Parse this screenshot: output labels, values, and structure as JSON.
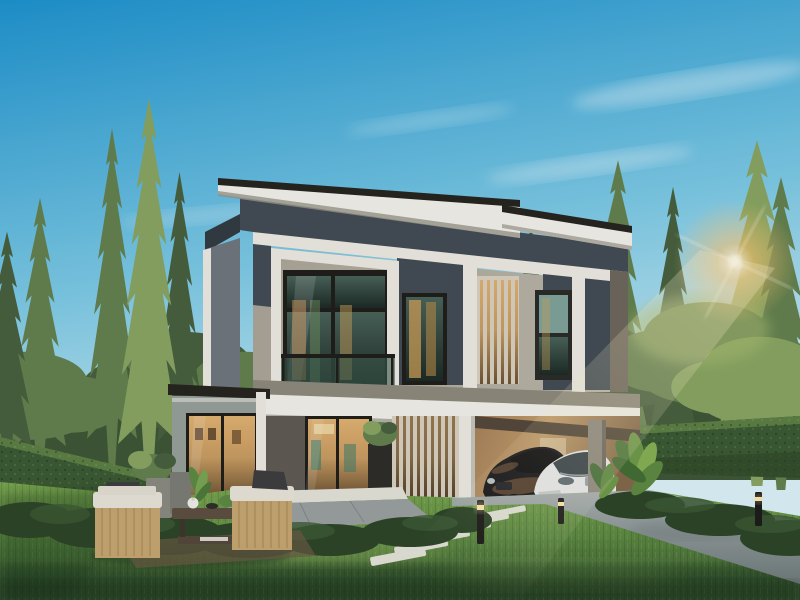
{
  "image": {
    "type": "3d-architectural-rendering",
    "description": "Exterior rendering of a modern two-storey detached house with slanted dark roof, glass balcony, timber louver screens, carport with two cars, outdoor lounge furniture on a manicured lawn, clipped hedge fences and tall conifer trees under a blue sky with sun glare",
    "time_of_day": "late-afternoon"
  },
  "scene": {
    "objects": [
      "blue sky with wispy clouds",
      "sun glare through pine trees",
      "conifer trees",
      "pine trees",
      "clipped hedge fence left",
      "clipped hedge fence right",
      "modern two-storey house",
      "skillion dark roof",
      "white roof fascia",
      "charcoal upper wall band",
      "glass balcony with green railing",
      "black-framed windows with warm reflections",
      "vertical timber louver screen",
      "white floor slab beam",
      "single-storey side wing with glass door",
      "dining room glass wall with warm interior",
      "timber slat feature wall",
      "black planter with shrub",
      "carport with tan interior wall",
      "black coupe car",
      "white sedan car",
      "tropical foliage plants",
      "concrete driveway",
      "white stepping stones",
      "terrace paving",
      "outdoor wooden armchairs with white cushions",
      "coffee table with tea set",
      "stone garden planters",
      "bollard path lights",
      "manicured green lawn",
      "foreground shrub hedging"
    ]
  },
  "palette": {
    "sky-top": "#1d93cf",
    "sky-mid": "#7ccae6",
    "sky-horizon": "#dcf2f9",
    "cloud-white": "#ffffff",
    "sun-core": "#fffdf0",
    "sun-glow": "#ffc873",
    "foliage-dark": "#47603e",
    "foliage-mid": "#64814f",
    "foliage-light": "#88a562",
    "foliage-warm": "#a9bb72",
    "canopy-back": "#3e5637",
    "hedge-dark": "#2d4528",
    "hedge-mid": "#3c5a34",
    "hedge-light": "#5d7f45",
    "lawn-light": "#7aa64f",
    "lawn-mid": "#5d8a42",
    "lawn-dark": "#33512e",
    "roof-dark": "#26241f",
    "soffit-white": "#f2f1ea",
    "slate-wall": "#434c55",
    "slate-dark": "#333b43",
    "wall-taupe": "#aba698",
    "wall-taupe-light": "#bab5a8",
    "wall-side-gray": "#70767e",
    "trim-white": "#eceae2",
    "wing-gray": "#97a09b",
    "frame-black": "#1f1e1a",
    "glass-top": "#49635a",
    "glass-bottom": "#1c2a25",
    "interior-warm": "#c99d62",
    "interior-dark": "#6e5334",
    "timber-cream": "#d8d1c0",
    "carport-tan": "#c49e6b",
    "drive-light": "#a9b1b1",
    "drive-dark": "#6e7a7a",
    "car-black": "#17171a",
    "car-bronze": "#8a6242",
    "car-white": "#e9eced",
    "car-glass": "#39444a",
    "furniture-wood": "#c7a772",
    "cushion-white": "#e8e4d8",
    "pillow-dark": "#3e3e40",
    "planter-gray": "#8b8b83",
    "table-wood": "#5d5042",
    "stone-white": "#e3e3da",
    "bollard-black": "#1c1c1a",
    "bollard-glow": "#ffe8ae"
  }
}
